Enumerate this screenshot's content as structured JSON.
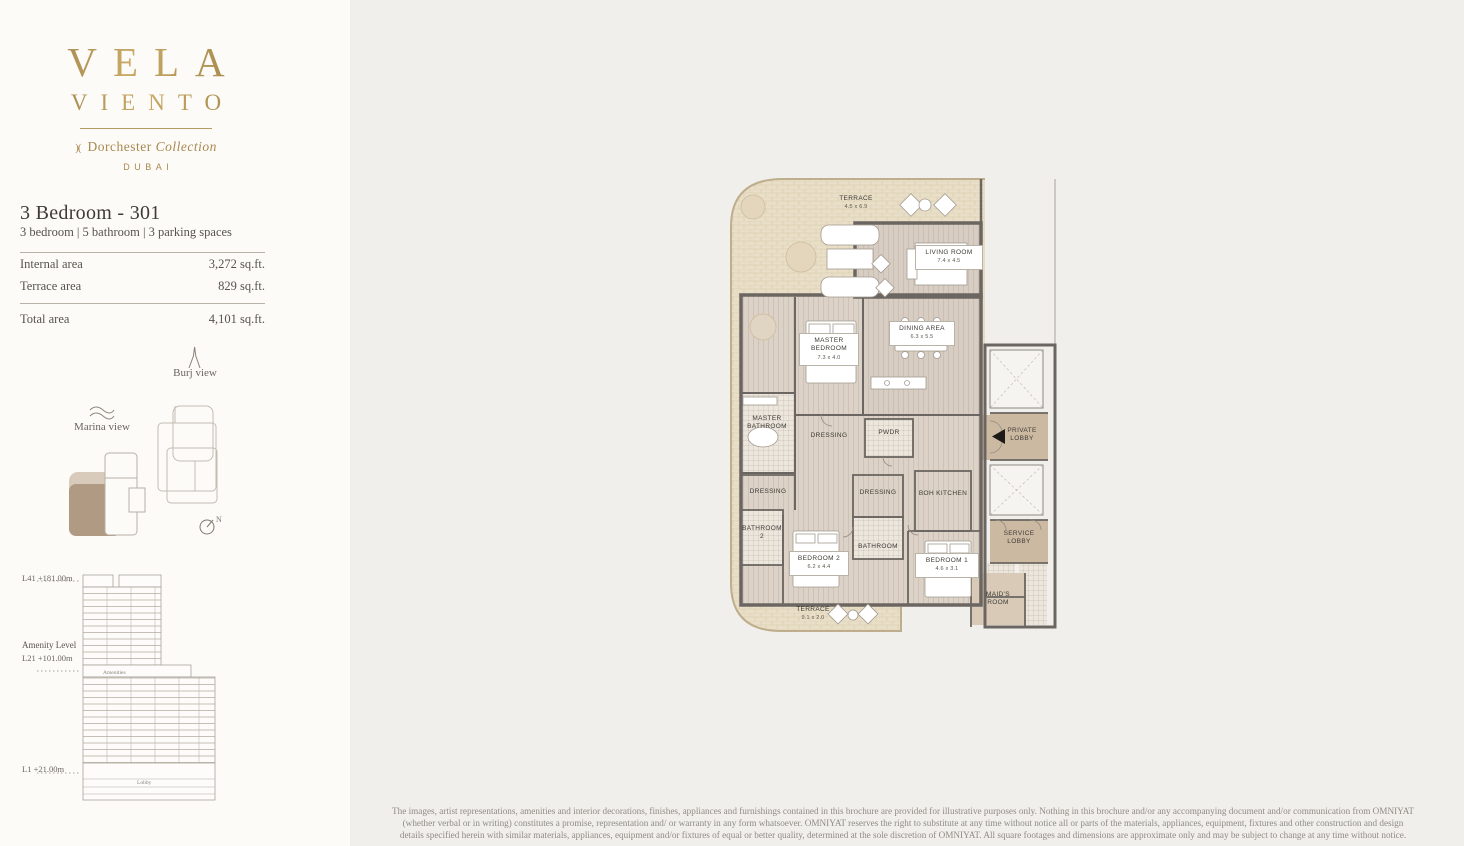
{
  "brand": {
    "name_line1": "VELA",
    "name_line2": "VIENTO",
    "collection_mark": ")(",
    "collection_name": "Dorchester",
    "collection_word": "Collection",
    "city": "DUBAI"
  },
  "unit": {
    "title": "3 Bedroom - 301",
    "subtitle": "3 bedroom | 5 bathroom | 3 parking spaces",
    "areas": [
      {
        "label": "Internal area",
        "value": "3,272 sq.ft."
      },
      {
        "label": "Terrace area",
        "value": "829 sq.ft."
      }
    ],
    "total": {
      "label": "Total area",
      "value": "4,101 sq.ft."
    }
  },
  "views": {
    "burj": "Burj view",
    "marina": "Marina view",
    "compass": "N"
  },
  "elevation": {
    "top_label": "L41 +181.00m",
    "amenity_title": "Amenity Level",
    "amenity_label": "L21 +101.00m",
    "ground_label": "L1 +21.00m",
    "amenities": "Amenities",
    "lobby": "Lobby"
  },
  "plan": {
    "rooms": {
      "terrace_top": {
        "name": "TERRACE",
        "dims": "4.5 x 6.9"
      },
      "living": {
        "name": "LIVING ROOM",
        "dims": "7.4 x 4.5"
      },
      "dining": {
        "name": "DINING AREA",
        "dims": "6.3 x 5.5"
      },
      "master_bedroom": {
        "name": "MASTER BEDROOM",
        "dims": "7.3 x 4.0"
      },
      "master_bathroom": {
        "name": "MASTER BATHROOM"
      },
      "dressing_top": {
        "name": "DRESSING"
      },
      "pwdr": {
        "name": "PWDR"
      },
      "private_lobby": {
        "name": "PRIVATE LOBBY"
      },
      "dressing_left": {
        "name": "DRESSING"
      },
      "dressing_mid": {
        "name": "DRESSING"
      },
      "boh_kitchen": {
        "name": "BOH KITCHEN"
      },
      "bathroom_2": {
        "name": "BATHROOM 2"
      },
      "bathroom": {
        "name": "BATHROOM"
      },
      "bedroom_2": {
        "name": "BEDROOM 2",
        "dims": "6.2 x 4.4"
      },
      "bedroom_1": {
        "name": "BEDROOM 1",
        "dims": "4.6 x 3.1"
      },
      "service_lobby": {
        "name": "SERVICE LOBBY"
      },
      "maids_room": {
        "name": "MAID'S ROOM"
      },
      "terrace_bottom": {
        "name": "TERRACE",
        "dims": "9.1 x 2.0"
      }
    },
    "colors": {
      "accent_gold": "#a8894f",
      "highlight_brown": "#b19a84",
      "wall": "#6b6661",
      "terrace_fill": "#e9dfc8",
      "floor_fill": "#dcd2c7"
    }
  },
  "disclaimer": "The images, artist representations, amenities and interior decorations, finishes, appliances and furnishings contained in this brochure are provided for illustrative purposes only. Nothing in this brochure and/or any accompanying document and/or communication from OMNIYAT (whether verbal or in writing) constitutes a promise, representation and/ or warranty in any form whatsoever. OMNIYAT reserves the right to substitute at any time without notice all or parts of the materials, appliances, equipment, fixtures and other construction and design details specified herein with similar materials, appliances, equipment and/or fixtures of equal or better quality, determined at the sole discretion of OMNIYAT. All square footages and dimensions are approximate only and may be subject to change at any time without notice."
}
